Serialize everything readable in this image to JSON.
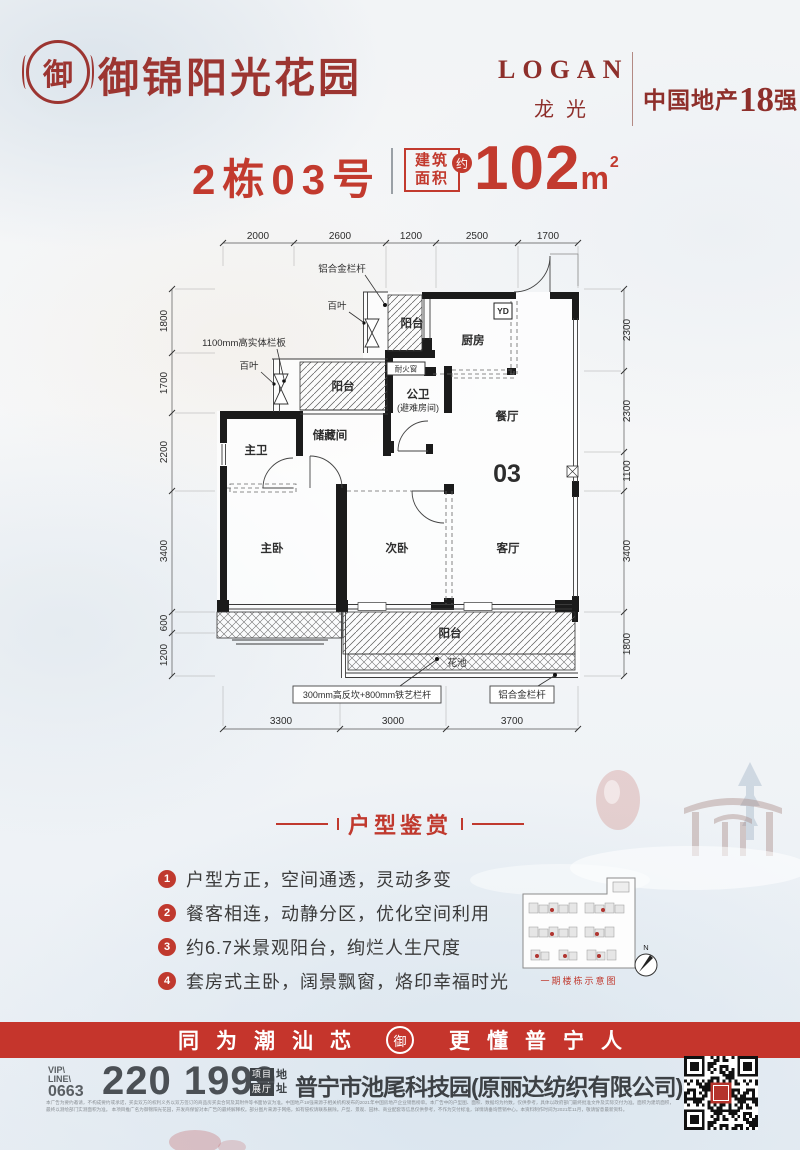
{
  "header": {
    "logo_char": "御",
    "brand": "御锦阳光花园",
    "logan_en": "LOGAN",
    "logan_cn": "龙光",
    "rank_prefix": "中国地产",
    "rank_number": "18",
    "rank_suffix": "强"
  },
  "title": {
    "unit": "2栋03号",
    "area_label_1": "建筑",
    "area_label_2": "面积",
    "approx": "约",
    "area_value": "102",
    "area_unit": "m",
    "area_sup": "2"
  },
  "floorplan": {
    "dims_top": [
      "2000",
      "2600",
      "1200",
      "2500",
      "1700"
    ],
    "dims_left": [
      "1800",
      "1700",
      "2200",
      "3400",
      "600",
      "1200"
    ],
    "dims_right": [
      "2300",
      "2300",
      "1100",
      "3400",
      "1800"
    ],
    "dims_bottom": [
      "3300",
      "3000",
      "3700"
    ],
    "rooms": {
      "balcony_top": "阳台",
      "kitchen": "厨房",
      "dining": "餐厅",
      "guest_bath_1": "公卫",
      "guest_bath_2": "(避难房间)",
      "storage": "储藏间",
      "master_bath": "主卫",
      "master_bed": "主卧",
      "second_bed": "次卧",
      "living": "客厅",
      "balcony_mid": "阳台",
      "balcony_bottom": "阳台",
      "flower_bed": "花池",
      "unit_no": "03",
      "yd": "YD",
      "fire_window": "耐火窗"
    },
    "annotations": {
      "alu_rail_top": "铝合金栏杆",
      "louver_1": "百叶",
      "louver_2": "百叶",
      "solid_panel": "1100mm高实体栏板",
      "iron_rail": "300mm高反坎+800mm铁艺栏杆",
      "alu_rail_bottom": "铝合金栏杆"
    }
  },
  "features": {
    "heading": "户型鉴赏",
    "items": [
      {
        "num": "1",
        "text": "户型方正，空间通透，灵动多变"
      },
      {
        "num": "2",
        "text": "餐客相连，动静分区，优化空间利用"
      },
      {
        "num": "3",
        "text": "约6.7米景观阳台，绚烂人生尺度"
      },
      {
        "num": "4",
        "text": "套房式主卧，阔景飘窗，烙印幸福时光"
      }
    ]
  },
  "sitemap": {
    "caption": "一期楼栋示意图",
    "compass": "N"
  },
  "banner": {
    "left_text": "同为潮汕芯",
    "logo_char": "御",
    "right_text": "更懂普宁人"
  },
  "contact": {
    "vip_1": "VIP\\",
    "vip_2": "LINE\\",
    "vip_code": "0663",
    "phone": "220 1999",
    "badge_1": "项目",
    "badge_2": "展厅",
    "badge_3": "地",
    "badge_4": "址",
    "address": "普宁市池尾科技园(原丽达纺织有限公司)"
  },
  "disclaimer": {
    "line1": "本广告为要约邀请，不构成要约或承诺，买卖双方的权利义务以双方签订的商品房买卖合同及其附件等书面协议为准。中国地产18强来源于相关机构发布的2021年中国房地产企业销售榜单。本广告中的户型图、面积、数据均为约数，仅供参考，具体以政府部门最终批准文件及实际交付为准。面积为建筑面积，最终以测绘部门实测面积为准。",
    "line2": "本项目推广名为御锦阳光花园，开发商保留对本广告的最终解释权。部分图片来源于网络，如有侵权请联系删除。户型、景观、园林、商业配套等信息仅供参考，不作为交付标准，详情请垂询营销中心。本资料制作时间为2021年11月，敬请留意最新资料。"
  },
  "colors": {
    "brand_red": "#9c3531",
    "accent_red": "#c23a2e",
    "banner_red": "#c5352c"
  }
}
